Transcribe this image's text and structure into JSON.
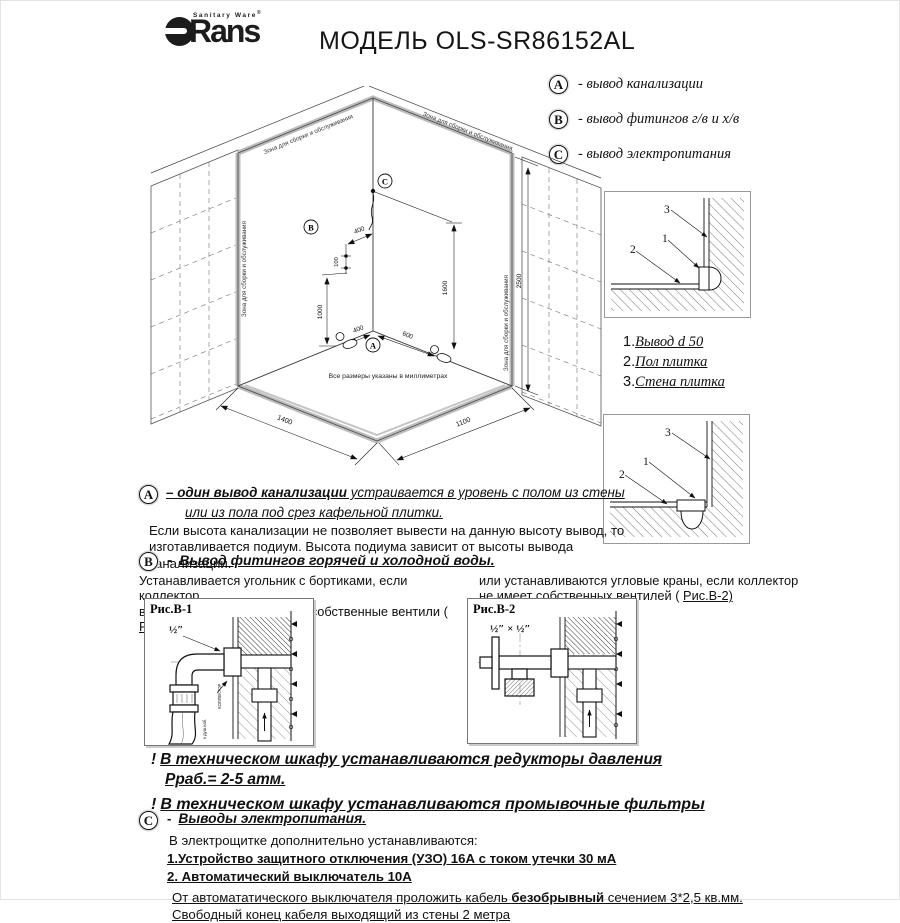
{
  "header": {
    "brand_sup": "Sanitary Ware",
    "reg": "®",
    "brand": "Rans",
    "title": "МОДЕЛЬ OLS-SR86152AL"
  },
  "legend": {
    "items": [
      {
        "letter": "A",
        "text": "-  вывод канализации"
      },
      {
        "letter": "B",
        "text": "-  вывод фитингов г/в и х/в"
      },
      {
        "letter": "C",
        "text": "-  вывод электропитания"
      }
    ]
  },
  "diagram": {
    "zone_label": "Зона для сборки и обслуживания",
    "note": "Все размеры указаны в миллиметрах",
    "marker_a": "A",
    "marker_b": "B",
    "marker_c": "C",
    "dims": {
      "wall_height": "2500",
      "power_height": "1600",
      "fitting_height": "1000",
      "fitting_offset": "400",
      "fitting_gap": "100",
      "drain_left": "400",
      "drain_right": "600",
      "floor_left": "1400",
      "floor_right": "1100"
    }
  },
  "details": {
    "callout_1": "1",
    "callout_2": "2",
    "callout_3": "3",
    "legend_items": [
      {
        "num": "1.",
        "label": "Вывод d 50"
      },
      {
        "num": "2.",
        "label": "Пол плитка"
      },
      {
        "num": "3.",
        "label": "Стена плитка"
      }
    ]
  },
  "section_a": {
    "letter": "A",
    "dash": "–",
    "bold": "один вывод канализации",
    "tail": " устраивается в уровень с полом из стены",
    "line2": "или из пола под срез кафельной плитки.",
    "line3": "Если высота канализации не позволяет вывести на данную высоту вывод, то",
    "line4": "изготавливается подиум. Высота подиума зависит от высоты вывода канализации."
  },
  "section_b": {
    "letter": "B",
    "dash": "-",
    "title": "Вывод фитингов горячей и холодной воды.",
    "left_line1": "Устанавливается угольник с бортиками,  если коллектор",
    "left_line2": "в техническом шкафу имеет собственные вентили ( ",
    "left_ref": "Рис.В-1)",
    "right_line1": "или  устанавливаются угловые краны, если коллектор",
    "right_line2": "не имеет собственных вентилей ( ",
    "right_ref": "Рис.В-2)",
    "fig1": {
      "caption": "Рис.В-1",
      "size": "½″",
      "label_collector": "КОЛЛЕКТОР",
      "label_hose": "к душ.каб."
    },
    "fig2": {
      "caption": "Рис.В-2",
      "size": "½″ × ½″"
    }
  },
  "warnings": {
    "mark": "!",
    "w1_line1": "В техническом шкафу устанавливаются редукторы давления",
    "w1_line2": "Рраб.= 2-5 атм.",
    "w2": "В техническом шкафу устанавливаются промывочные фильтры"
  },
  "section_c": {
    "letter": "C",
    "dash": "-",
    "title": "Выводы электропитания.",
    "intro": "В электрощитке дополнительно устанавливаются:",
    "item1": "1.Устройство защитного отключения (УЗО)  16А с током  утечки 30 мА",
    "item2": "2. Автоматический выключатель 10А",
    "note1_pre": "От автомататического выключателя проложить кабель ",
    "note1_bold": "безобрывный",
    "note1_post": " сечением 3*2,5 кв.мм.",
    "note2": "Свободный конец кабеля выходящий из стены 2 метра"
  }
}
